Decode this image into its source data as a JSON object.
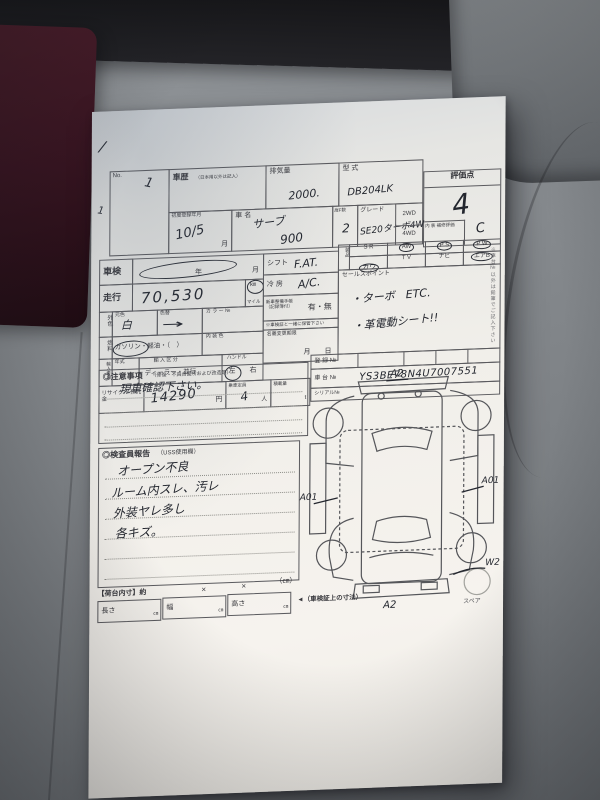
{
  "colors": {
    "seat_gray": "#878b8f",
    "seat_dark": "#141416",
    "seat_maroon": "#3a1522",
    "paper": "#f1efea",
    "print_ink": "#38383d",
    "pen_ink": "#23262e"
  },
  "sheet": {
    "no_box": {
      "label": "No.",
      "mark1": "1",
      "mark2": "1",
      "check": "/"
    },
    "header": {
      "history": {
        "label": "車歴",
        "sublabel": "（日本用以外は記入）"
      },
      "displacement": {
        "label": "排気量",
        "value": "2000."
      },
      "model_code": {
        "label": "型 式",
        "value": "DB204LK"
      },
      "score": {
        "label": "評価点",
        "value": "4",
        "interior_label": "内 装 補修評価",
        "interior_value": "C"
      },
      "first_reg": {
        "label": "初度登録年月",
        "value": "10/5",
        "unit": "月"
      },
      "car_name": {
        "label": "車  名",
        "value": "サーブ",
        "value2": "900"
      },
      "doors": {
        "label": "扉F数",
        "value": "2"
      },
      "grade": {
        "label": "グレード",
        "value": "SE20ターボ4W"
      },
      "drive": {
        "opt1": "2WD",
        "opt2": "4WD"
      }
    },
    "main": {
      "shaken": {
        "label": "車検",
        "year_unit": "年",
        "month_unit": "月"
      },
      "mileage": {
        "label": "走行",
        "value": "70,530",
        "unit_km": "㎞",
        "unit_mile": "マイル"
      },
      "shift": {
        "label": "シフト",
        "value": "F.AT."
      },
      "aircon": {
        "label": "冷 房",
        "value": "A/C."
      },
      "equipment": {
        "label": "装品",
        "row1": [
          "S R",
          "AW",
          "P S",
          "P W"
        ],
        "row2": [
          "カワ",
          "T V",
          "ナビ",
          "エアB"
        ],
        "circled": [
          "AW",
          "P S",
          "P W",
          "カワ",
          "エアB"
        ]
      },
      "sales_point": {
        "label": "セールスポイント",
        "line1": "・ターボ　ETC.",
        "line2": "・革電動シート!!"
      },
      "color": {
        "label": "外色",
        "base_label": "元色",
        "base_value": "白",
        "change_label": "色替",
        "change_value": "→",
        "color_no_label": "カ ラ ー №"
      },
      "record_book": {
        "label": "新車整備手帳 （記録簿付）",
        "value": "有・無"
      },
      "keep_note": "※車検証と一緒に保管下さい",
      "fuel": {
        "label": "燃料",
        "value": "ガソリン・軽油・（　）",
        "circled": "ガソリン"
      },
      "interior_color_label": "内 装 色",
      "import": {
        "label": "輸入車用",
        "year_label": "年式",
        "class_label": "輸 入 区 分",
        "class_value": "ディーラー・並行",
        "handle_label": "ハンドル",
        "handle_left": "左",
        "handle_right": "右",
        "circled": "左"
      },
      "transfer": {
        "label": "名義変更期限",
        "units": "月　　日"
      },
      "recycle": {
        "label": "リサイクル 預託金",
        "value": "14290",
        "unit": "円"
      },
      "capacity": {
        "label": "乗車定員",
        "value": "4",
        "unit": "人"
      },
      "load": {
        "label": "積載量",
        "unit": "t"
      },
      "reg_no": {
        "label": "登 録 №"
      },
      "chassis_no": {
        "label": "車 台 №",
        "value": "YS3BE78N4U7007551"
      },
      "serial_no": {
        "label": "シリアル№"
      }
    },
    "notes": {
      "title": "◎注意事項",
      "title_sub": "（修復・不具合箇所および改造等）",
      "line1": "現車確認下さい。"
    },
    "inspector": {
      "title": "◎検査員報告",
      "title_sub": "（USS使用欄）",
      "line1": "オープン不良",
      "line2": "ルーム内スレ、汚レ",
      "line3": "外装ヤレ多し",
      "line4": "各キズ。"
    },
    "diagram": {
      "front": "A2",
      "left": "A01",
      "right": "A01",
      "right_rear": "W2",
      "rear": "A2",
      "spare_label": "スペア"
    },
    "cargo": {
      "title": "【荷台内寸】約",
      "x1": "×",
      "x2": "×",
      "cm": "（㎝）",
      "length_label": "長さ",
      "width_label": "幅",
      "height_label": "高さ",
      "unit": "㎝",
      "note": "◄（車検証上の寸法）"
    },
    "side_note": "※車台№以外は鉛筆でご記入下さい"
  }
}
